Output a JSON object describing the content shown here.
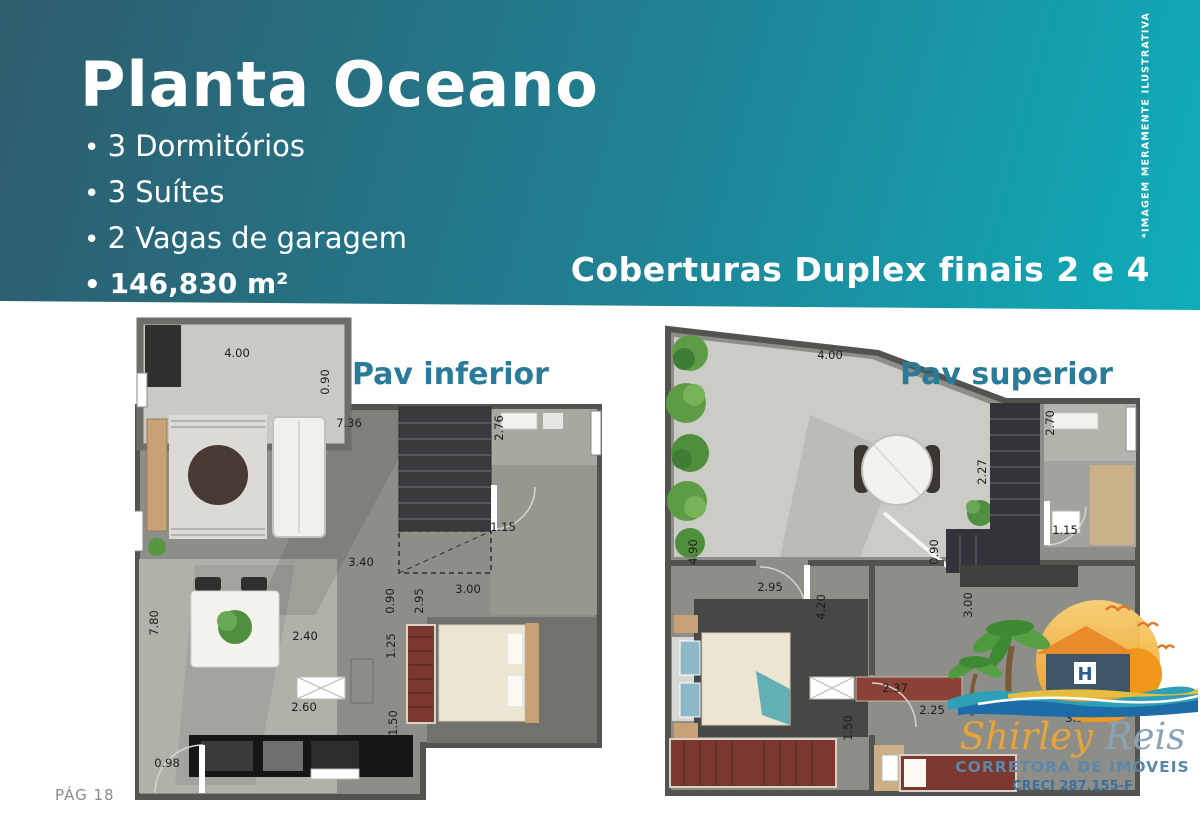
{
  "header": {
    "title": "Planta Oceano",
    "features": [
      "3 Dormitórios",
      "3 Suítes",
      "2 Vagas de garagem",
      "146,830 m²"
    ],
    "subtitle": "Coberturas Duplex finais 2 e 4",
    "disclaimer": "*IMAGEM MERAMENTE ILUSTRATIVA"
  },
  "plans": [
    {
      "label": "Pav inferior",
      "dims": [
        {
          "t": "4.00",
          "x": 102,
          "y": 38,
          "r": 0
        },
        {
          "t": "0.90",
          "x": 190,
          "y": 67,
          "r": 1
        },
        {
          "t": "7.36",
          "x": 214,
          "y": 108,
          "r": 0
        },
        {
          "t": "2.76",
          "x": 364,
          "y": 113,
          "r": 1
        },
        {
          "t": "1.15",
          "x": 368,
          "y": 212,
          "r": 0
        },
        {
          "t": "3.40",
          "x": 226,
          "y": 247,
          "r": 0
        },
        {
          "t": "0.90",
          "x": 255,
          "y": 286,
          "r": 1
        },
        {
          "t": "2.95",
          "x": 284,
          "y": 286,
          "r": 1
        },
        {
          "t": "3.00",
          "x": 333,
          "y": 274,
          "r": 0
        },
        {
          "t": "7.80",
          "x": 19,
          "y": 308,
          "r": 1
        },
        {
          "t": "2.40",
          "x": 170,
          "y": 321,
          "r": 0
        },
        {
          "t": "1.25",
          "x": 256,
          "y": 331,
          "r": 1
        },
        {
          "t": "2.60",
          "x": 169,
          "y": 392,
          "r": 0
        },
        {
          "t": "1.50",
          "x": 258,
          "y": 408,
          "r": 1
        },
        {
          "t": "0.98",
          "x": 32,
          "y": 448,
          "r": 0
        }
      ]
    },
    {
      "label": "Pav superior",
      "dims": [
        {
          "t": "4.00",
          "x": 170,
          "y": 40,
          "r": 0
        },
        {
          "t": "2.70",
          "x": 390,
          "y": 108,
          "r": 1
        },
        {
          "t": "2.27",
          "x": 322,
          "y": 157,
          "r": 1
        },
        {
          "t": "1.15",
          "x": 405,
          "y": 215,
          "r": 0
        },
        {
          "t": "4.90",
          "x": 33,
          "y": 237,
          "r": 1
        },
        {
          "t": "0.90",
          "x": 274,
          "y": 237,
          "r": 1
        },
        {
          "t": "2.95",
          "x": 110,
          "y": 272,
          "r": 0
        },
        {
          "t": "4.20",
          "x": 161,
          "y": 292,
          "r": 1
        },
        {
          "t": "3.00",
          "x": 308,
          "y": 290,
          "r": 1
        },
        {
          "t": "2.37",
          "x": 235,
          "y": 373,
          "r": 0
        },
        {
          "t": "2.25",
          "x": 272,
          "y": 395,
          "r": 0
        },
        {
          "t": "1.50",
          "x": 188,
          "y": 413,
          "r": 1
        },
        {
          "t": "3.00",
          "x": 418,
          "y": 403,
          "r": 0
        }
      ]
    }
  ],
  "footer": {
    "page_number": "PÁG 18"
  },
  "logo": {
    "brand_first": "Shirley",
    "brand_last": "Reis",
    "tagline": "CORRETORA DE IMÓVEIS",
    "creci": "CRECI 287.155-F"
  },
  "colors": {
    "header_dark": "#2e5c6d",
    "header_teal": "#0fadbb",
    "plan_label_blue": "#2a7b99",
    "logo_orange": "#e8a33c",
    "logo_script_blue": "#8aa2b5",
    "tagline_blue": "#5b87a8",
    "creci_blue": "#3a6fa0",
    "wall_gray": "#53534f",
    "terrace_floor": "#cbccc5",
    "interior_floor": "#8e8e89",
    "furniture_red": "#7c382e"
  }
}
